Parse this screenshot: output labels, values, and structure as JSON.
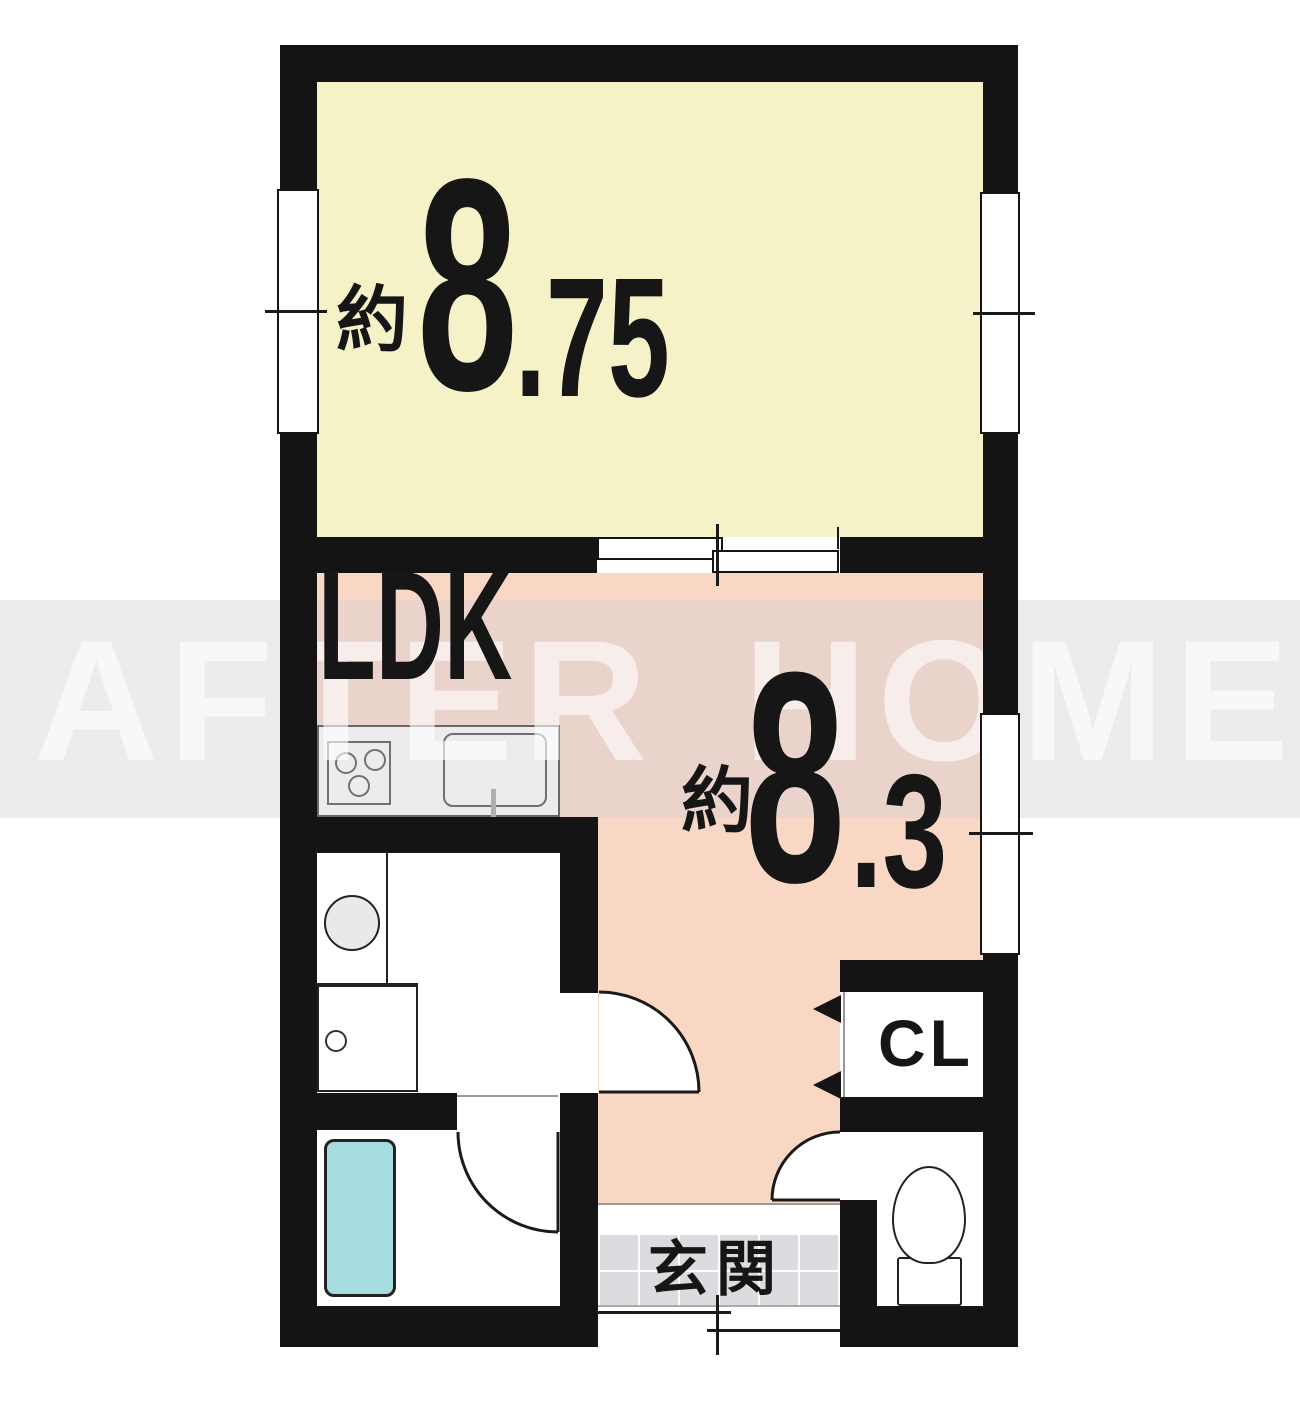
{
  "title": "1LDK apartment floor plan",
  "watermark": {
    "text": "AFTER HOME",
    "band_color": "#f0eef1",
    "letter_color": "#fdfcfd"
  },
  "rooms": {
    "western_room": {
      "approx_label": "約",
      "size_whole": "8",
      "size_fraction": ".75",
      "floor_color": "#f4f2c6"
    },
    "ldk": {
      "name": "LDK",
      "approx_label": "約",
      "size_whole": "8",
      "size_fraction": ".3",
      "floor_color": "#f8d7c5"
    },
    "closet": {
      "label": "CL"
    },
    "entrance": {
      "label": "玄関",
      "tile_color": "#dcdbe0"
    }
  },
  "fixtures": {
    "stove": "3-burner-stove",
    "kitchen_sink": "kitchen-sink",
    "washbasin": "washbasin",
    "washing_machine": "washing-machine-pan",
    "bathtub": "bathtub",
    "toilet": "toilet"
  },
  "colors": {
    "wall": "#141414",
    "bathtub": "#a6dcdf",
    "door_arc": "#1a1a1a"
  }
}
